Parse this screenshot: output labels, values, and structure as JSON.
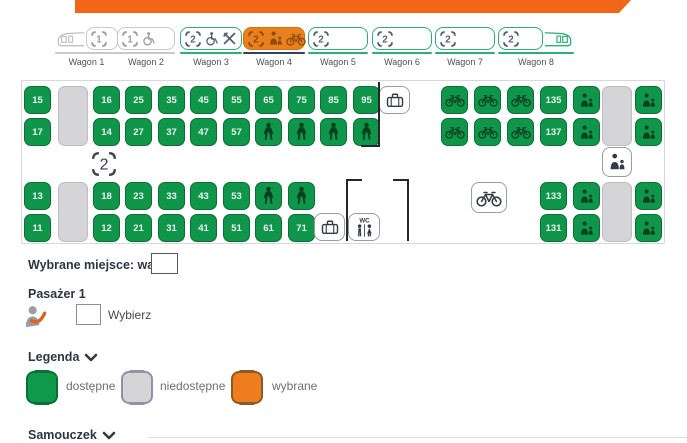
{
  "colors": {
    "brand_orange": "#f2661a",
    "selected_orange": "#e8801e",
    "seat_green": "#10964a",
    "seat_green_dark": "#0a6e37",
    "wagon_green": "#2fae76",
    "navy_underline": "#39415f",
    "blocked_gray": "#d5d5d7"
  },
  "wagon_bar": {
    "lefts": [
      55,
      117,
      180,
      243,
      308,
      372,
      435,
      498
    ],
    "items": [
      {
        "label": "Wagon 1",
        "variant": "gray",
        "train": "head",
        "box_w": 32,
        "icons": [
          [
            "seat",
            "1"
          ]
        ]
      },
      {
        "label": "Wagon 2",
        "variant": "gray",
        "train": "",
        "box_w": 58,
        "icons": [
          [
            "seat",
            "1"
          ],
          [
            "wheelchair",
            ""
          ]
        ]
      },
      {
        "label": "Wagon 3",
        "variant": "green",
        "train": "",
        "box_w": 62,
        "icons": [
          [
            "seat",
            "2"
          ],
          [
            "wheelchair",
            ""
          ],
          [
            "cutlery",
            ""
          ]
        ]
      },
      {
        "label": "Wagon 4",
        "variant": "selected",
        "train": "",
        "box_w": 62,
        "icons": [
          [
            "seat",
            "2"
          ],
          [
            "parent-child",
            ""
          ],
          [
            "bike",
            ""
          ]
        ]
      },
      {
        "label": "Wagon 5",
        "variant": "green",
        "train": "",
        "box_w": 60,
        "icons": [
          [
            "seat",
            "2"
          ]
        ]
      },
      {
        "label": "Wagon 6",
        "variant": "green",
        "train": "",
        "box_w": 60,
        "icons": [
          [
            "seat",
            "2"
          ]
        ]
      },
      {
        "label": "Wagon 7",
        "variant": "green",
        "train": "",
        "box_w": 60,
        "icons": [
          [
            "seat",
            "2"
          ]
        ]
      },
      {
        "label": "Wagon 8",
        "variant": "green",
        "train": "tail",
        "box_w": 45,
        "icons": [
          [
            "seat",
            "2"
          ]
        ]
      }
    ]
  },
  "car": {
    "seats": [
      [
        2,
        5,
        "num",
        "15"
      ],
      [
        71,
        5,
        "num",
        "16"
      ],
      [
        103,
        5,
        "num",
        "25"
      ],
      [
        136,
        5,
        "num",
        "35"
      ],
      [
        168,
        5,
        "num",
        "45"
      ],
      [
        201,
        5,
        "num",
        "55"
      ],
      [
        233,
        5,
        "num",
        "65"
      ],
      [
        266,
        5,
        "num",
        "75"
      ],
      [
        298,
        5,
        "num",
        "85"
      ],
      [
        331,
        5,
        "num",
        "95"
      ],
      [
        419,
        5,
        "bike",
        ""
      ],
      [
        452,
        5,
        "bike",
        ""
      ],
      [
        485,
        5,
        "bike",
        ""
      ],
      [
        518,
        5,
        "num",
        "135"
      ],
      [
        551,
        5,
        "pc",
        ""
      ],
      [
        613,
        5,
        "pc",
        ""
      ],
      [
        2,
        37,
        "num",
        "17"
      ],
      [
        71,
        37,
        "num",
        "14"
      ],
      [
        103,
        37,
        "num",
        "27"
      ],
      [
        136,
        37,
        "num",
        "37"
      ],
      [
        168,
        37,
        "num",
        "47"
      ],
      [
        201,
        37,
        "num",
        "57"
      ],
      [
        233,
        37,
        "person",
        ""
      ],
      [
        266,
        37,
        "person",
        ""
      ],
      [
        298,
        37,
        "person",
        ""
      ],
      [
        331,
        37,
        "person",
        ""
      ],
      [
        419,
        37,
        "bike",
        ""
      ],
      [
        452,
        37,
        "bike",
        ""
      ],
      [
        485,
        37,
        "bike",
        ""
      ],
      [
        518,
        37,
        "num",
        "137"
      ],
      [
        551,
        37,
        "pc",
        ""
      ],
      [
        613,
        37,
        "pc",
        ""
      ],
      [
        2,
        101,
        "num",
        "13"
      ],
      [
        71,
        101,
        "num",
        "18"
      ],
      [
        103,
        101,
        "num",
        "23"
      ],
      [
        136,
        101,
        "num",
        "33"
      ],
      [
        168,
        101,
        "num",
        "43"
      ],
      [
        201,
        101,
        "num",
        "53"
      ],
      [
        233,
        101,
        "person",
        ""
      ],
      [
        266,
        101,
        "person",
        ""
      ],
      [
        518,
        101,
        "num",
        "133"
      ],
      [
        551,
        101,
        "pc",
        ""
      ],
      [
        613,
        101,
        "pc",
        ""
      ],
      [
        2,
        133,
        "num",
        "11"
      ],
      [
        71,
        133,
        "num",
        "12"
      ],
      [
        103,
        133,
        "num",
        "21"
      ],
      [
        136,
        133,
        "num",
        "31"
      ],
      [
        168,
        133,
        "num",
        "41"
      ],
      [
        201,
        133,
        "num",
        "51"
      ],
      [
        233,
        133,
        "num",
        "61"
      ],
      [
        266,
        133,
        "num",
        "71"
      ],
      [
        518,
        133,
        "num",
        "131"
      ],
      [
        551,
        133,
        "pc",
        ""
      ],
      [
        613,
        133,
        "pc",
        ""
      ]
    ],
    "blocks": [
      [
        36,
        5,
        30,
        60
      ],
      [
        580,
        5,
        30,
        60
      ],
      [
        36,
        101,
        30,
        60
      ],
      [
        580,
        101,
        30,
        60
      ]
    ],
    "markers": [
      [
        357,
        5,
        31,
        28,
        "luggage"
      ],
      [
        65,
        68,
        33,
        30,
        "class2"
      ],
      [
        580,
        66,
        30,
        30,
        "parent-child"
      ],
      [
        449,
        101,
        36,
        31,
        "bike"
      ],
      [
        292,
        132,
        31,
        28,
        "luggage"
      ],
      [
        326,
        132,
        32,
        28,
        "wc"
      ]
    ],
    "marker_texts": {
      "wc": "WC",
      "class2": "2"
    },
    "walls": [
      [
        356,
        1,
        2,
        64
      ],
      [
        339,
        64,
        19,
        2
      ],
      [
        324,
        98,
        2,
        62
      ],
      [
        324,
        98,
        16,
        2
      ],
      [
        385,
        98,
        2,
        62
      ],
      [
        371,
        98,
        16,
        2
      ]
    ]
  },
  "selection": {
    "label": "Wybrane miejsce: wagon",
    "value": ""
  },
  "passenger": {
    "title": "Pasażer 1",
    "action_label": "Wybierz",
    "value": ""
  },
  "legend": {
    "title": "Legenda",
    "items": [
      {
        "label": "dostępne",
        "type": "available",
        "seat_x": 26,
        "label_x": 66
      },
      {
        "label": "niedostępne",
        "type": "unavailable",
        "seat_x": 121,
        "label_x": 160
      },
      {
        "label": "wybrane",
        "type": "selected",
        "seat_x": 231,
        "label_x": 272
      }
    ]
  },
  "tutorial": {
    "title": "Samouczek"
  }
}
